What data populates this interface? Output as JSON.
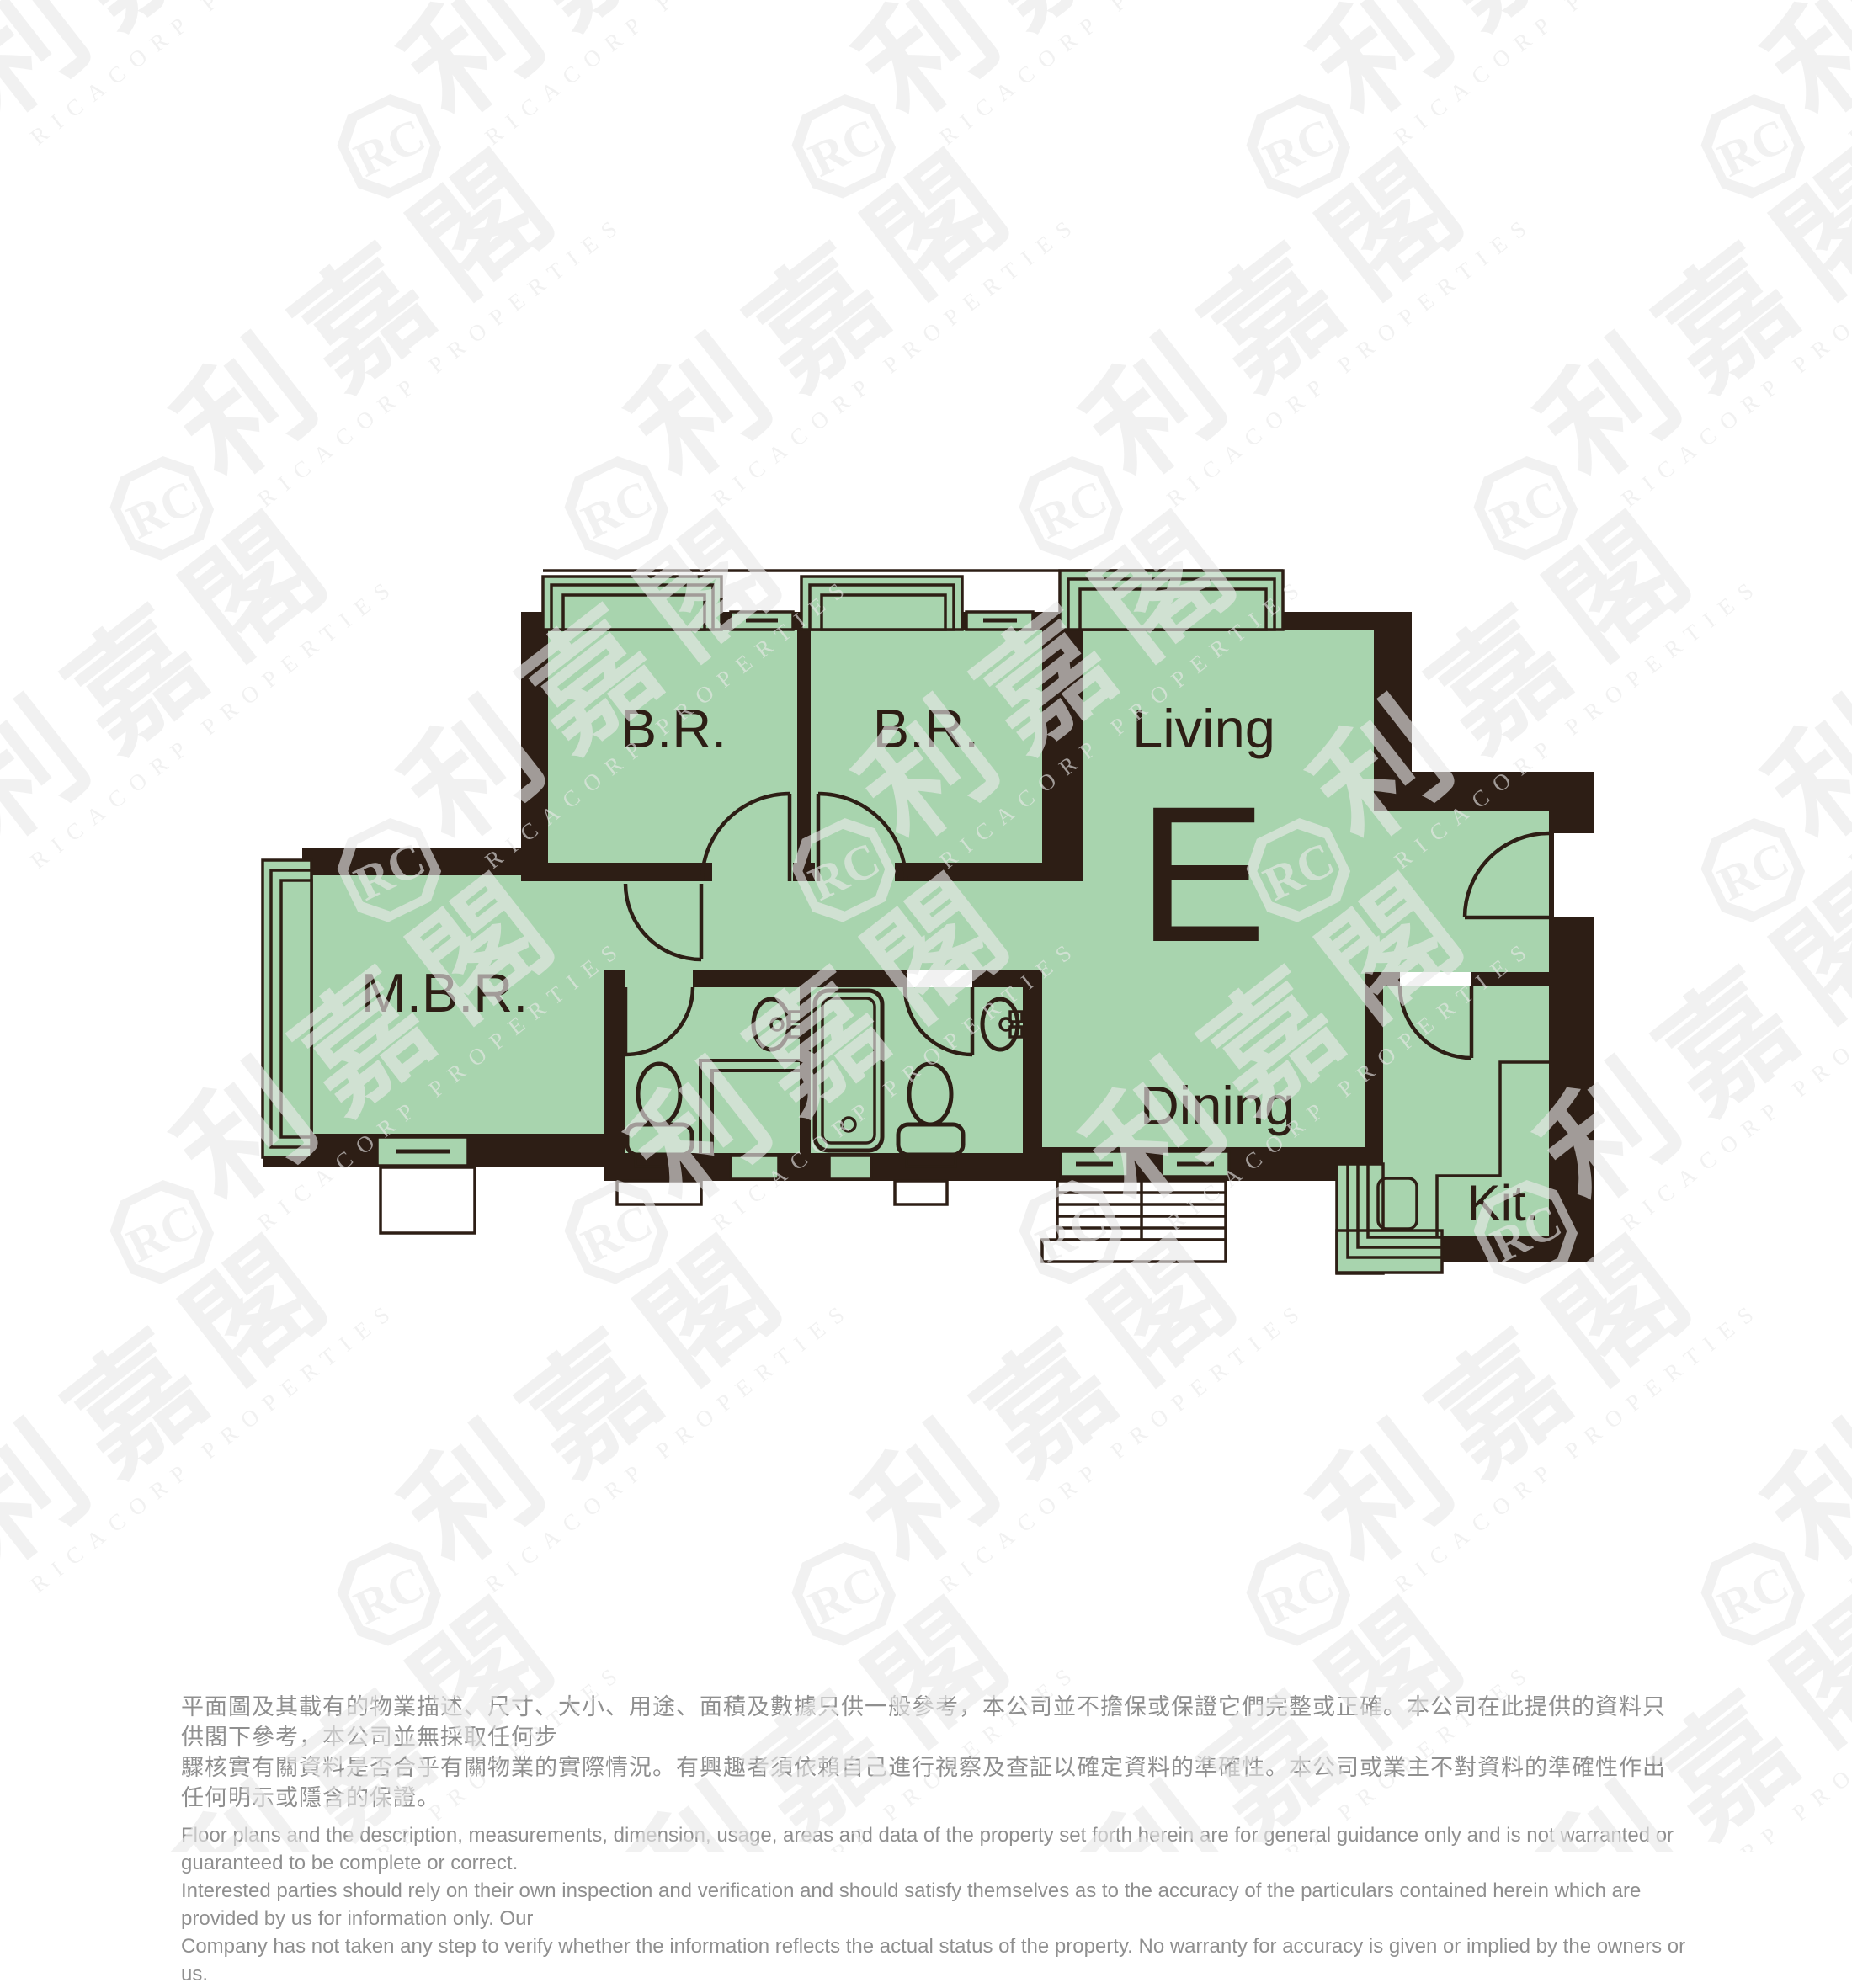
{
  "floorplan": {
    "unit_label": "E",
    "rooms": [
      {
        "id": "br1",
        "label": "B.R."
      },
      {
        "id": "br2",
        "label": "B.R."
      },
      {
        "id": "living",
        "label": "Living"
      },
      {
        "id": "mbr",
        "label": "M.B.R."
      },
      {
        "id": "dining",
        "label": "Dining"
      },
      {
        "id": "kitchen",
        "label": "Kit."
      }
    ],
    "colors": {
      "floor_green": "#a8d4ae",
      "wall_dark": "#2d1e15",
      "background": "#ffffff",
      "disclaimer_gray": "#8f8f8f"
    }
  },
  "watermark": {
    "logo_text": "利嘉閣",
    "seal_text": "RC",
    "subtext": "RICACORP PROPERTIES"
  },
  "disclaimer": {
    "zh": [
      "平面圖及其載有的物業描述、尺寸、大小、用途、面積及數據只供一般參考，本公司並不擔保或保證它們完整或正確。本公司在此提供的資料只供閣下參考，本公司並無採取任何步",
      "驟核實有關資料是否合乎有關物業的實際情況。有興趣者須依賴自己進行視察及查証以確定資料的準確性。本公司或業主不對資料的準確性作出任何明示或隱含的保證。"
    ],
    "en": [
      "Floor plans and the description, measurements, dimension, usage, areas and data of the property set forth herein are for general guidance only and is not warranted or guaranteed to be complete or correct.",
      "Interested parties should rely on their own inspection and verification and should satisfy themselves as to the accuracy of the particulars contained herein which are provided by us for information only.  Our",
      "Company has not taken any step to verify whether the information reflects the actual status of the property.  No warranty for accuracy is given or implied by the owners or us."
    ]
  }
}
